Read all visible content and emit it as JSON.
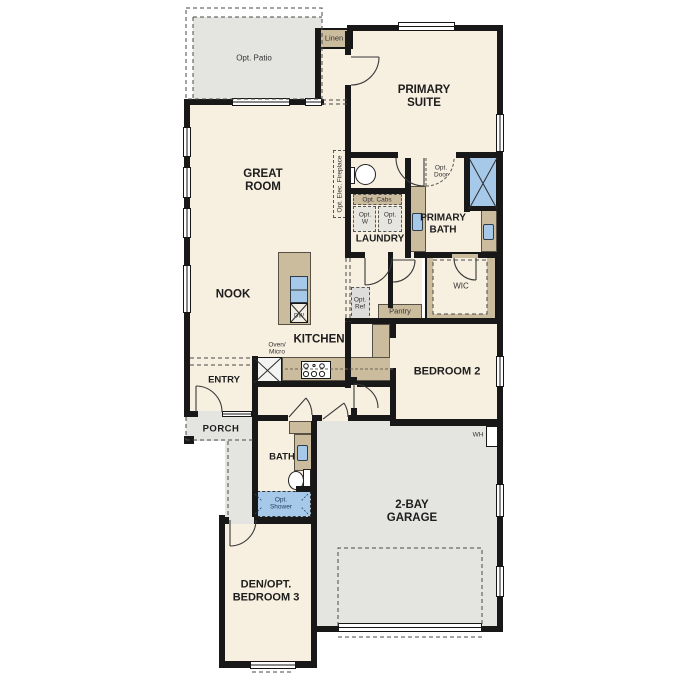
{
  "floorplan": {
    "colors": {
      "floor": "#f7efe0",
      "tan": "#cbbc9e",
      "gray": "#e4e4e1",
      "blue": "#a6c9e9",
      "wall": "#181818",
      "text": "#2a2a2a"
    },
    "rooms": {
      "opt_patio": "Opt. Patio",
      "linen": "Linen",
      "primary_suite": "PRIMARY SUITE",
      "great_room": "GREAT ROOM",
      "nook": "NOOK",
      "kitchen": "KITCHEN",
      "laundry": "LAUNDRY",
      "primary_bath": "PRIMARY BATH",
      "wic": "WIC",
      "bedroom_2": "BEDROOM 2",
      "entry": "ENTRY",
      "porch": "PORCH",
      "bath": "BATH",
      "garage": "2-BAY GARAGE",
      "den": "DEN/OPT. BEDROOM 3",
      "pantry": "Pantry"
    },
    "features": {
      "opt_elec_fireplace": "Opt. Elec. Fireplace",
      "opt_cabs": "Opt. Cabs",
      "opt_w": "Opt. W",
      "opt_d": "Opt. D",
      "opt_door": "Opt. Door",
      "opt_ref": "Opt. Ref",
      "oven_micro": "Oven/ Micro",
      "dw": "DW",
      "wh": "WH",
      "opt_shower": "Opt. Shower"
    }
  }
}
